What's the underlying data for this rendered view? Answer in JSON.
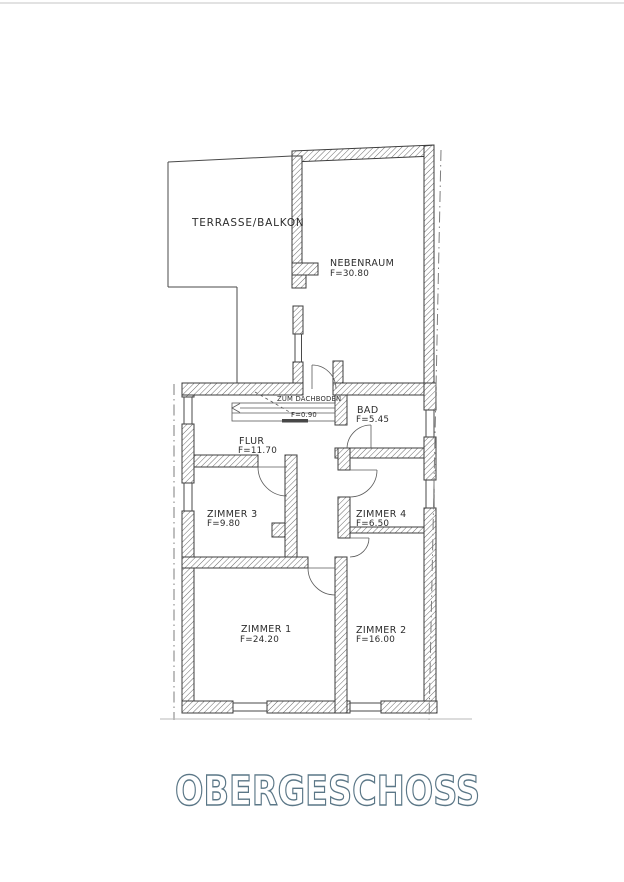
{
  "title": {
    "text": "OBERGESCHOSS"
  },
  "rooms": [
    {
      "name": "TERRASSE/BALKON"
    },
    {
      "name": "NEBENRAUM",
      "area": "F=30.80"
    },
    {
      "name": "BAD",
      "area": "F=5.45"
    },
    {
      "name": "FLUR",
      "area": "F=11.70"
    },
    {
      "name": "ZIMMER 3",
      "area": "F=9.80"
    },
    {
      "name": "ZIMMER 4",
      "area": "F=6.50"
    },
    {
      "name": "ZIMMER 1",
      "area": "F=24.20"
    },
    {
      "name": "ZIMMER 2",
      "area": "F=16.00"
    }
  ],
  "annotations": {
    "stair_label": "ZUM DACHBODEN",
    "stair_width": "F=0.90"
  },
  "colors": {
    "ink": "#3d3d3d",
    "title_outline": "#5b7787",
    "boundary": "#7d7d7d"
  }
}
